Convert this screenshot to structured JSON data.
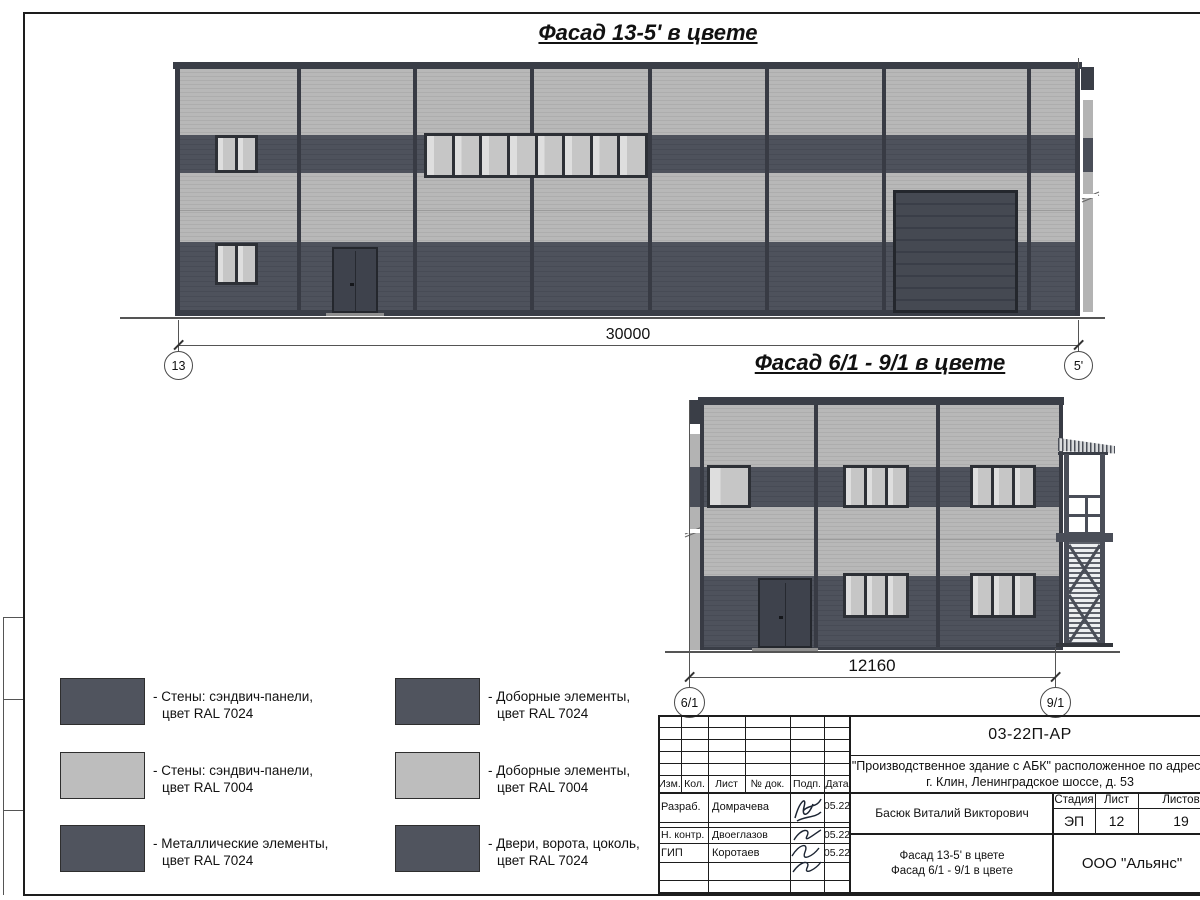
{
  "drawing": {
    "facade1": {
      "title": "Фасад 13-5' в цвете",
      "dimension": "30000",
      "axis_left": "13",
      "axis_right": "5'"
    },
    "facade2": {
      "title": "Фасад 6/1 - 9/1 в цвете",
      "dimension": "12160",
      "axis_left": "6/1",
      "axis_right": "9/1"
    }
  },
  "legend": {
    "items": [
      {
        "color": "#50545e",
        "line1": "- Стены: сэндвич-панели,",
        "line2": "цвет RAL 7024"
      },
      {
        "color": "#bdbdbd",
        "line1": "- Стены: сэндвич-панели,",
        "line2": "цвет RAL 7004"
      },
      {
        "color": "#50545e",
        "line1": "- Металлические элементы,",
        "line2": "цвет RAL 7024"
      },
      {
        "color": "#50545e",
        "line1": "- Доборные элементы,",
        "line2": "цвет RAL 7024"
      },
      {
        "color": "#bdbdbd",
        "line1": "- Доборные элементы,",
        "line2": "цвет RAL 7004"
      },
      {
        "color": "#50545e",
        "line1": "- Двери, ворота, цоколь,",
        "line2": "цвет RAL 7024"
      }
    ]
  },
  "titleblock": {
    "doc_number": "03-22П-АР",
    "project_line1": "\"Производственное здание с АБК\" расположенное по адресу:",
    "project_line2": "г. Клин, Ленинградское шоссе, д. 53",
    "columns": [
      "Изм.",
      "Кол.",
      "Лист",
      "№ док.",
      "Подп.",
      "Дата"
    ],
    "staff": [
      {
        "role": "Разраб.",
        "name": "Домрачева",
        "date": "05.22"
      },
      {
        "role": "Н. контр.",
        "name": "Двоеглазов",
        "date": "05.22"
      },
      {
        "role": "ГИП",
        "name": "Коротаев",
        "date": "05.22"
      }
    ],
    "approver": "Басюк Виталий Викторович",
    "stage_label": "Стадия",
    "sheet_label": "Лист",
    "sheets_label": "Листов",
    "stage": "ЭП",
    "sheet": "12",
    "sheets": "19",
    "drawing_name_line1": "Фасад 13-5' в цвете",
    "drawing_name_line2": "Фасад 6/1 - 9/1 в цвете",
    "company": "ООО \"Альянс\""
  },
  "colors": {
    "panel_dark_ral7024": "#4e525c",
    "panel_light_ral7004": "#b7b7b7",
    "metal_ral7024": "#41454f"
  }
}
